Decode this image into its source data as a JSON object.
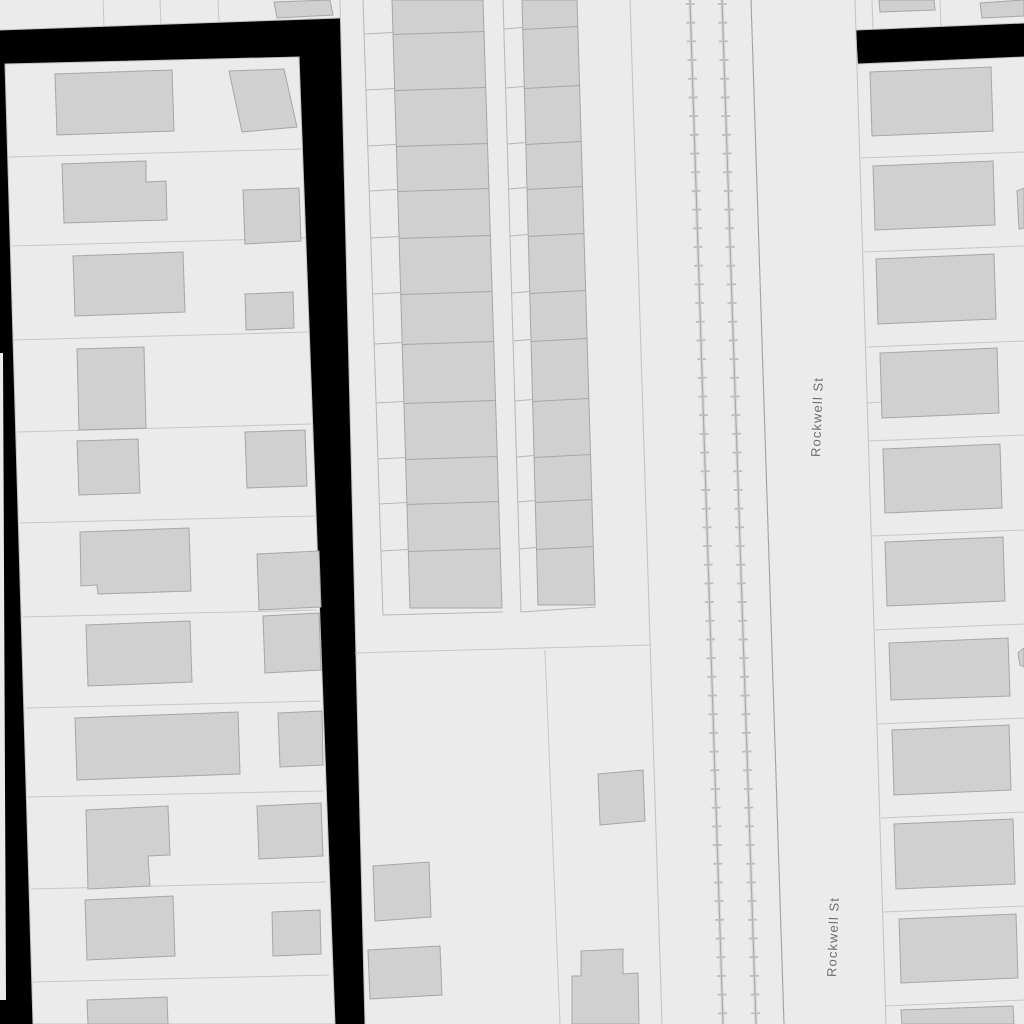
{
  "map": {
    "type": "parcel-basemap",
    "street_labels": [
      "Rockwell St",
      "Rockwell St"
    ],
    "features": {
      "street_name": "Rockwell St",
      "railroad_tracks": 2
    },
    "colors": {
      "background": "#000000",
      "parcel_fill": "#ebebeb",
      "building_fill": "#d0d0d0",
      "building_stroke": "#a6a6a6",
      "parcel_line": "#c6c6c6",
      "railroad_line": "#a9a9a9",
      "railroad_tick": "#bdbdbd",
      "right_of_way_line": "#a2a2a2",
      "label_color": "#6e6e6e",
      "label_halo": "#ededed"
    }
  }
}
